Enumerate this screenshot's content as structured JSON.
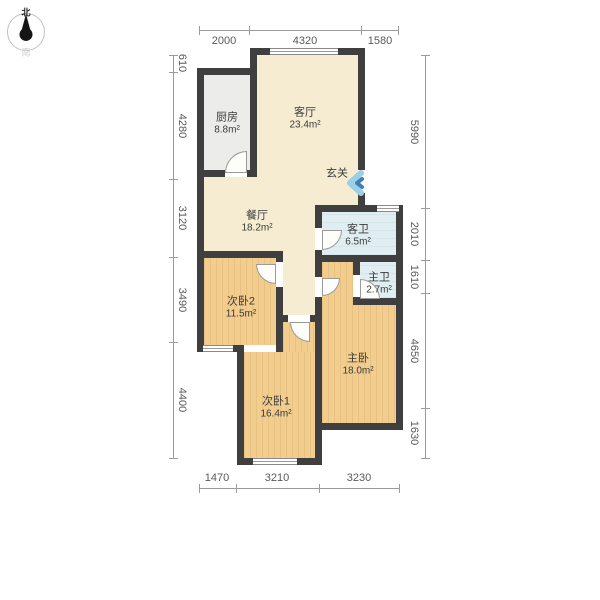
{
  "compass": {
    "north": "北",
    "south": "南"
  },
  "dimensions": {
    "top": [
      "2000",
      "4320",
      "1580"
    ],
    "bottom": [
      "1470",
      "3210",
      "3230"
    ],
    "left": [
      "610",
      "4280",
      "3120",
      "3490",
      "4400"
    ],
    "right": [
      "5990",
      "2010",
      "1610",
      "4650",
      "1630"
    ]
  },
  "rooms": {
    "kitchen": {
      "name": "厨房",
      "area": "8.8m²"
    },
    "living": {
      "name": "客厅",
      "area": "23.4m²"
    },
    "entry": {
      "name": "玄关"
    },
    "dining": {
      "name": "餐厅",
      "area": "18.2m²"
    },
    "guest_bath": {
      "name": "客卫",
      "area": "6.5m²"
    },
    "master_bath": {
      "name": "主卫",
      "area": "2.7m²"
    },
    "bedroom2": {
      "name": "次卧2",
      "area": "11.5m²"
    },
    "master_bed": {
      "name": "主卧",
      "area": "18.0m²"
    },
    "bedroom1": {
      "name": "次卧1",
      "area": "16.4m²"
    }
  },
  "colors": {
    "wall": "#3f3f3f",
    "floor_wood": "#f3cd8e",
    "floor_cream": "#f6ecd2",
    "floor_tile_gray": "#ececea",
    "floor_tile_blue": "#e0eef1",
    "entry_arrow_light": "#9ccfe6",
    "entry_arrow_dark": "#3e7fb0",
    "dimension_text": "#595959"
  }
}
